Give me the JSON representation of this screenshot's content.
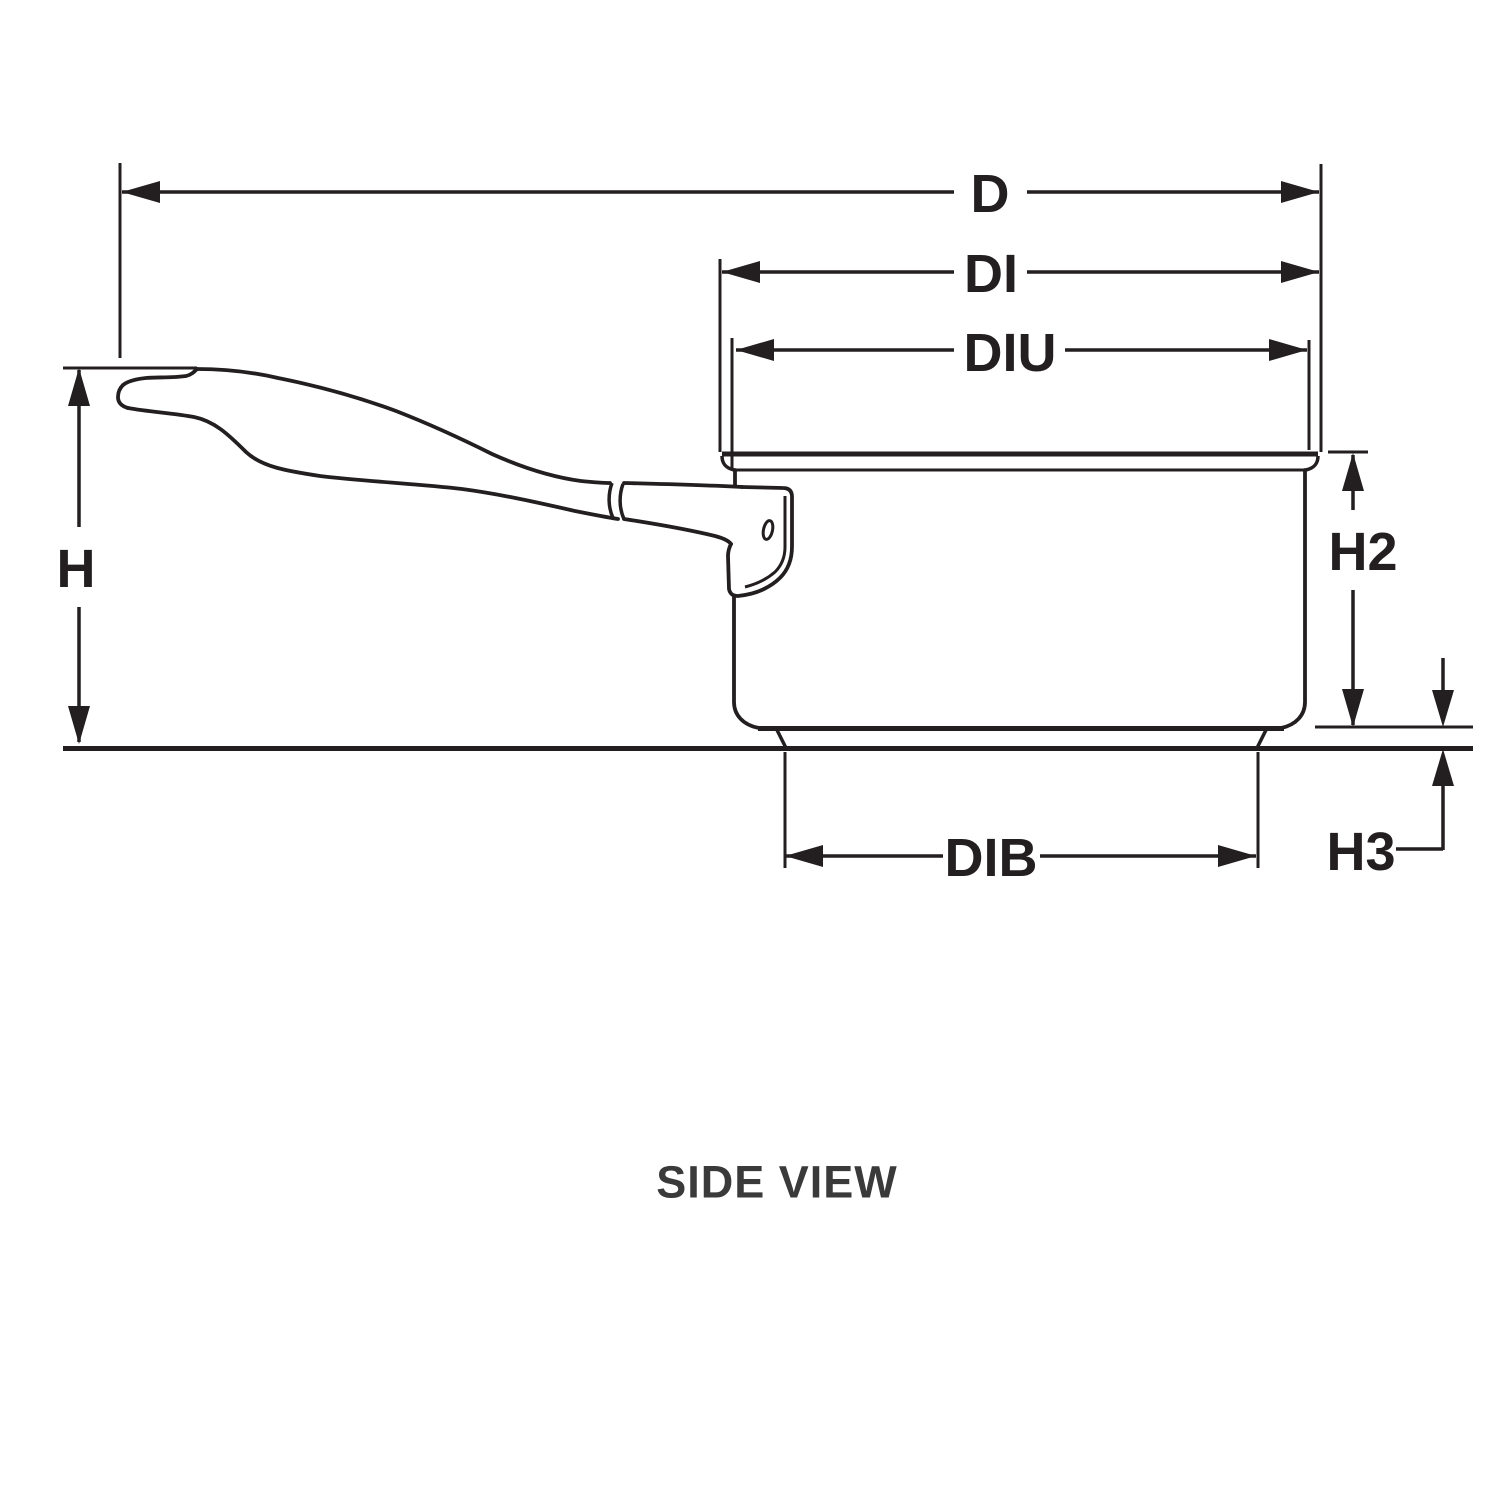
{
  "diagram": {
    "caption": "SIDE VIEW",
    "labels": {
      "d": "D",
      "di": "DI",
      "diu": "DIU",
      "h": "H",
      "h2": "H2",
      "h3": "H3",
      "dib": "DIB"
    },
    "colors": {
      "background": "#ffffff",
      "line": "#231f20",
      "label_background": "#ffffff",
      "caption_color": "#3a3a3a"
    }
  }
}
